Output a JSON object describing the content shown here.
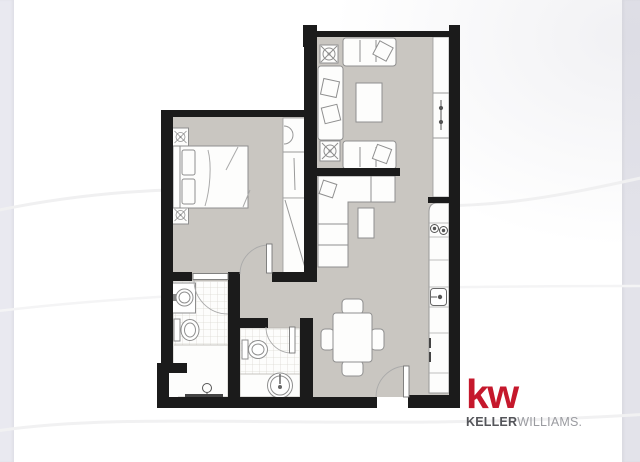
{
  "branding": {
    "logo_mark": "kw",
    "logo_name_bold": "KELLER",
    "logo_name_light": "WILLIAMS.",
    "brand_red": "#C5182C",
    "name_bold_color": "#54555A",
    "name_light_color": "#9B9CA1"
  },
  "canvas": {
    "background": "#FFFFFF",
    "left_band_color": "#E9E9F0",
    "right_band_color": "#E3E3EA",
    "wave_line_color": "#F0F0F2"
  },
  "floorplan": {
    "wall_color": "#1b1b1b",
    "floor_color": "#c9c6c1",
    "room_fill": "#fdfdfc",
    "tile_line_color": "#dcd9d4",
    "furniture_outline": "#8f8f8f",
    "door_arc_color": "#a8a8a8",
    "rooms": [
      "living-room",
      "bedroom",
      "ensuite-bathroom",
      "second-bathroom",
      "hallway",
      "kitchen",
      "dining-area",
      "closet",
      "window-ledge"
    ],
    "fixtures": [
      "bed",
      "nightstand",
      "table-lamp",
      "wardrobe",
      "sofa",
      "chaise-lounge",
      "coffee-table",
      "side-table",
      "sectional-sofa",
      "ottoman",
      "dining-table",
      "dining-chair",
      "kitchen-counter",
      "cooktop",
      "kitchen-sink",
      "refrigerator",
      "bathroom-sink",
      "toilet",
      "shower",
      "round-basin",
      "door-swing",
      "entry-door",
      "window-handle"
    ]
  }
}
